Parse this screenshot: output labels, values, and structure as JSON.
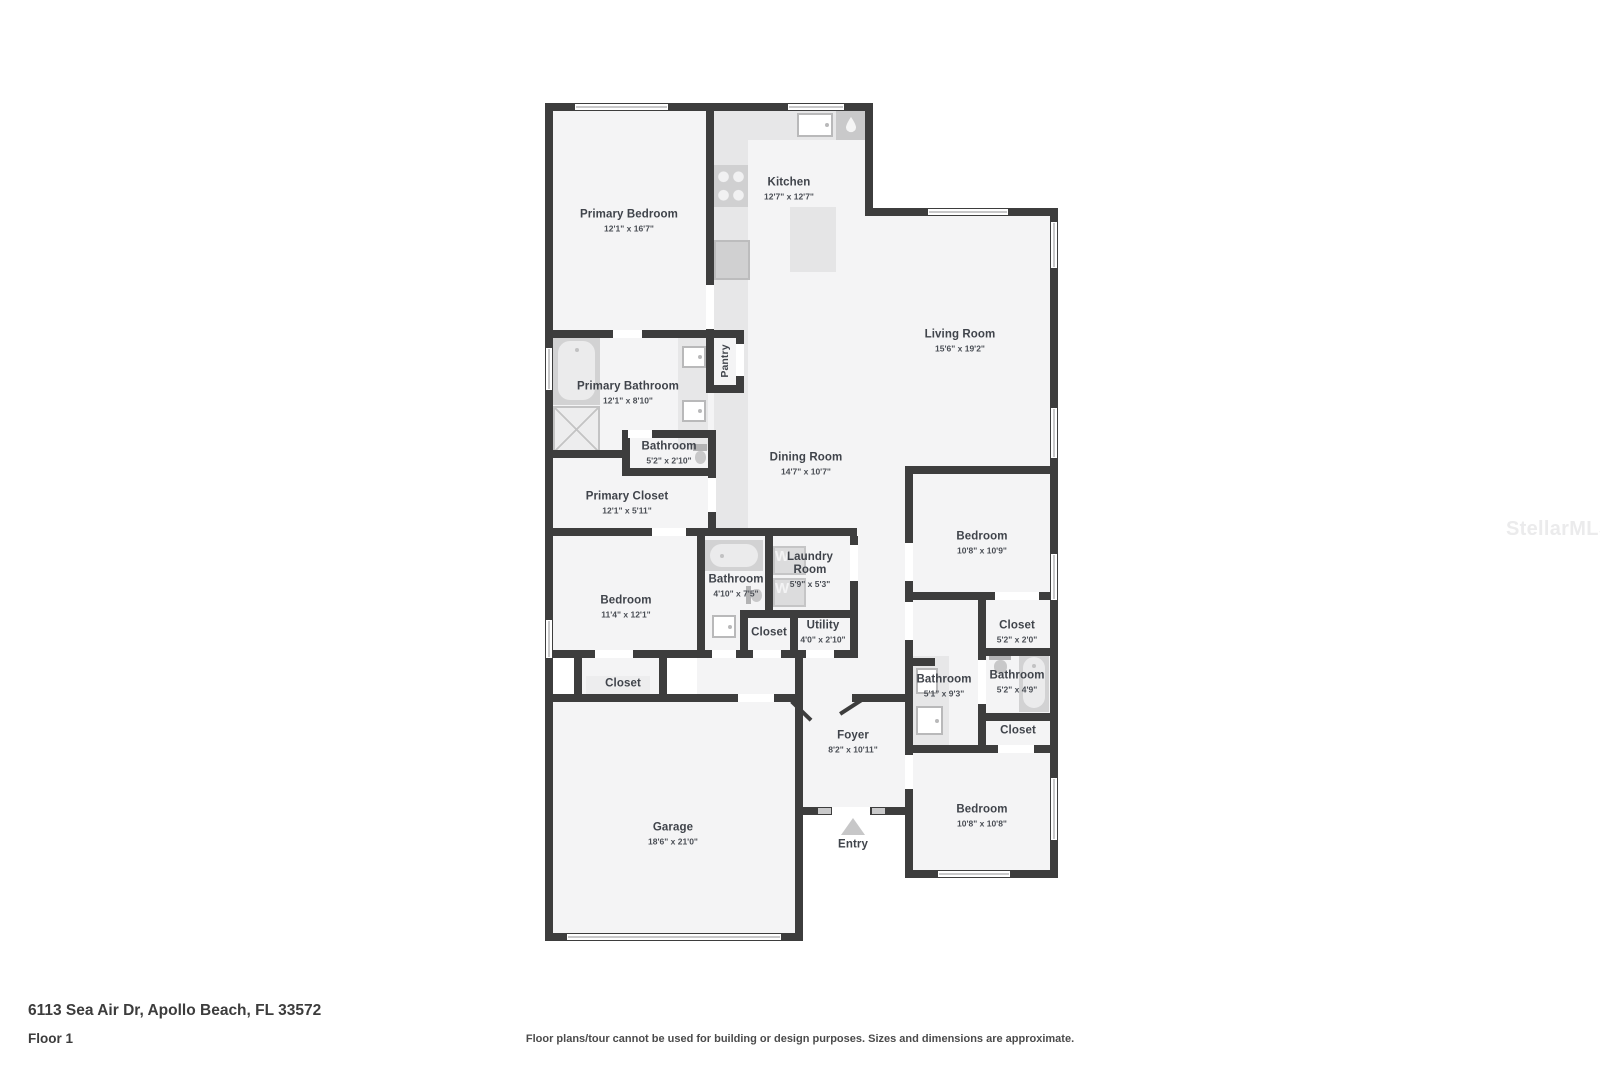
{
  "plan": {
    "rooms": {
      "primary_bedroom": {
        "name": "Primary Bedroom",
        "dims": "12'1\" x 16'7\""
      },
      "kitchen": {
        "name": "Kitchen",
        "dims": "12'7\" x 12'7\""
      },
      "living_room": {
        "name": "Living Room",
        "dims": "15'6\" x 19'2\""
      },
      "primary_bathroom": {
        "name": "Primary Bathroom",
        "dims": "12'1\" x 8'10\""
      },
      "pantry": {
        "name": "Pantry"
      },
      "water_closet": {
        "name": "Bathroom",
        "dims": "5'2\" x 2'10\""
      },
      "primary_closet": {
        "name": "Primary Closet",
        "dims": "12'1\" x 5'11\""
      },
      "dining_room": {
        "name": "Dining Room",
        "dims": "14'7\" x 10'7\""
      },
      "bedroom_left": {
        "name": "Bedroom",
        "dims": "11'4\" x 12'1\""
      },
      "bedroom_closet": {
        "name": "Closet"
      },
      "hall_bathroom": {
        "name": "Bathroom",
        "dims": "4'10\" x 7'5\""
      },
      "laundry_room": {
        "name": "Laundry Room",
        "dims": "5'9\" x 5'3\""
      },
      "hall_closet": {
        "name": "Closet"
      },
      "utility": {
        "name": "Utility",
        "dims": "4'0\" x 2'10\""
      },
      "bedroom_back": {
        "name": "Bedroom",
        "dims": "10'8\" x 10'9\""
      },
      "back_closet": {
        "name": "Closet",
        "dims": "5'2\" x 2'0\""
      },
      "bathroom_back": {
        "name": "Bathroom",
        "dims": "5'1\" x 9'3\""
      },
      "bathroom_ensuite": {
        "name": "Bathroom",
        "dims": "5'2\" x 4'9\""
      },
      "ensuite_closet": {
        "name": "Closet"
      },
      "bedroom_front": {
        "name": "Bedroom",
        "dims": "10'8\" x 10'8\""
      },
      "foyer": {
        "name": "Foyer",
        "dims": "8'2\" x 10'11\""
      },
      "garage": {
        "name": "Garage",
        "dims": "18'6\" x 21'0\""
      },
      "entry": {
        "name": "Entry"
      }
    },
    "appliances": {
      "washer_label": "W",
      "dryer_label": "W"
    }
  },
  "footer": {
    "address": "6113 Sea Air Dr, Apollo Beach, FL 33572",
    "floor_label": "Floor 1",
    "disclaimer": "Floor plans/tour cannot be used for building or design purposes. Sizes and dimensions are approximate."
  },
  "watermark": {
    "text": "StellarMLS"
  },
  "colors": {
    "wall": "#3d3d3d",
    "floor": "#f4f4f5",
    "counter_shade": "#e7e7e8",
    "fixture": "#d6d6d7",
    "label_text": "#40444b",
    "watermark_text": "#ebebec"
  }
}
